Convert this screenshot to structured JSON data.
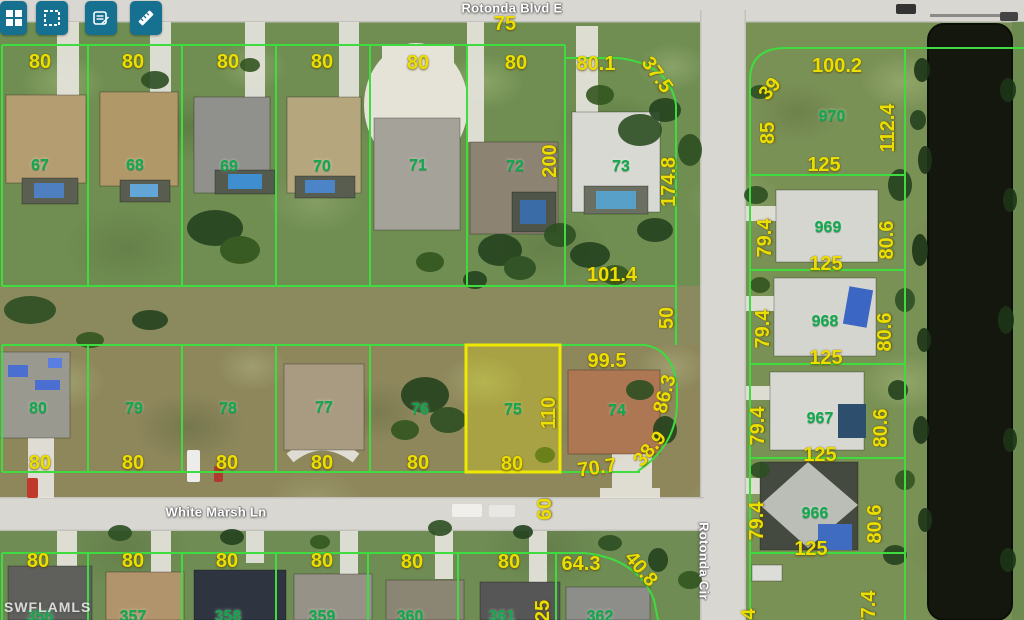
{
  "app": {
    "type": "parcel-map-viewer"
  },
  "colors": {
    "toolbar_teal": "#16708f",
    "parcel_line_green": "#3fdc3f",
    "highlight_yellow": "#efe800",
    "dimension_yellow": "#ecdf00",
    "parcel_number_green": "#14a84e",
    "water_dark": "#14170d",
    "road_gray": "#d8d7d2"
  },
  "toolbar": {
    "buttons": [
      {
        "icon": "layout-grid-icon"
      },
      {
        "icon": "select-area-icon"
      },
      {
        "icon": "notes-edit-icon"
      },
      {
        "icon": "measure-ruler-icon"
      }
    ]
  },
  "watermark": "SWFLAMLS",
  "highlight": {
    "parcel": "75"
  },
  "map_labels": {
    "streets": [
      {
        "t": "Rotonda Blvd E",
        "x": 512,
        "y": 8,
        "r": 0
      },
      {
        "t": "White Marsh Ln",
        "x": 216,
        "y": 512,
        "r": 0
      },
      {
        "t": "Rotonda Cir",
        "x": 704,
        "y": 561,
        "r": 90
      }
    ],
    "parcel_numbers": [
      {
        "t": "67",
        "x": 40,
        "y": 166
      },
      {
        "t": "68",
        "x": 135,
        "y": 166
      },
      {
        "t": "69",
        "x": 229,
        "y": 167
      },
      {
        "t": "70",
        "x": 322,
        "y": 167
      },
      {
        "t": "71",
        "x": 418,
        "y": 166
      },
      {
        "t": "72",
        "x": 515,
        "y": 167
      },
      {
        "t": "73",
        "x": 621,
        "y": 167
      },
      {
        "t": "970",
        "x": 832,
        "y": 117
      },
      {
        "t": "969",
        "x": 828,
        "y": 228
      },
      {
        "t": "968",
        "x": 825,
        "y": 322
      },
      {
        "t": "967",
        "x": 820,
        "y": 419
      },
      {
        "t": "966",
        "x": 815,
        "y": 514
      },
      {
        "t": "80",
        "x": 38,
        "y": 409
      },
      {
        "t": "79",
        "x": 134,
        "y": 409
      },
      {
        "t": "78",
        "x": 228,
        "y": 409
      },
      {
        "t": "77",
        "x": 324,
        "y": 408
      },
      {
        "t": "76",
        "x": 420,
        "y": 410
      },
      {
        "t": "75",
        "x": 513,
        "y": 410
      },
      {
        "t": "74",
        "x": 617,
        "y": 411
      },
      {
        "t": "356",
        "x": 40,
        "y": 617
      },
      {
        "t": "357",
        "x": 133,
        "y": 617
      },
      {
        "t": "358",
        "x": 228,
        "y": 617
      },
      {
        "t": "359",
        "x": 322,
        "y": 617
      },
      {
        "t": "360",
        "x": 410,
        "y": 617
      },
      {
        "t": "361",
        "x": 502,
        "y": 617
      },
      {
        "t": "362",
        "x": 600,
        "y": 617
      }
    ],
    "dimensions": [
      {
        "t": "80",
        "x": 40,
        "y": 62
      },
      {
        "t": "80",
        "x": 133,
        "y": 62
      },
      {
        "t": "80",
        "x": 228,
        "y": 62
      },
      {
        "t": "80",
        "x": 322,
        "y": 62
      },
      {
        "t": "80",
        "x": 418,
        "y": 63
      },
      {
        "t": "80",
        "x": 516,
        "y": 63
      },
      {
        "t": "80.1",
        "x": 596,
        "y": 64
      },
      {
        "t": "37.5",
        "x": 657,
        "y": 75,
        "r": 55
      },
      {
        "t": "200",
        "x": 550,
        "y": 161,
        "r": -90
      },
      {
        "t": "174.8",
        "x": 669,
        "y": 182,
        "r": -90
      },
      {
        "t": "75",
        "x": 505,
        "y": 24
      },
      {
        "t": "101.4",
        "x": 612,
        "y": 275
      },
      {
        "t": "50",
        "x": 667,
        "y": 318,
        "r": -90
      },
      {
        "t": "100.2",
        "x": 837,
        "y": 66
      },
      {
        "t": "39",
        "x": 770,
        "y": 89,
        "r": -50
      },
      {
        "t": "85",
        "x": 768,
        "y": 133,
        "r": -90
      },
      {
        "t": "112.4",
        "x": 888,
        "y": 128,
        "r": -90
      },
      {
        "t": "125",
        "x": 824,
        "y": 165
      },
      {
        "t": "79.4",
        "x": 765,
        "y": 238,
        "r": -90
      },
      {
        "t": "80.6",
        "x": 887,
        "y": 240,
        "r": -90
      },
      {
        "t": "125",
        "x": 826,
        "y": 264
      },
      {
        "t": "79.4",
        "x": 763,
        "y": 329,
        "r": -90
      },
      {
        "t": "80.6",
        "x": 885,
        "y": 332,
        "r": -90
      },
      {
        "t": "125",
        "x": 826,
        "y": 358
      },
      {
        "t": "79.4",
        "x": 758,
        "y": 426,
        "r": -90
      },
      {
        "t": "80.6",
        "x": 881,
        "y": 428,
        "r": -90
      },
      {
        "t": "125",
        "x": 820,
        "y": 455
      },
      {
        "t": "79.4",
        "x": 757,
        "y": 521,
        "r": -90
      },
      {
        "t": "80.6",
        "x": 875,
        "y": 524,
        "r": -90
      },
      {
        "t": "125",
        "x": 811,
        "y": 549
      },
      {
        "t": "77.4",
        "x": 869,
        "y": 610,
        "r": -90
      },
      {
        "t": "79.4",
        "x": 749,
        "y": 628,
        "r": -90
      },
      {
        "t": "99.5",
        "x": 607,
        "y": 361
      },
      {
        "t": "110",
        "x": 549,
        "y": 413,
        "r": -90
      },
      {
        "t": "86.3",
        "x": 665,
        "y": 394,
        "r": -75
      },
      {
        "t": "38.9",
        "x": 650,
        "y": 449,
        "r": -50
      },
      {
        "t": "70.7",
        "x": 597,
        "y": 468,
        "r": -8
      },
      {
        "t": "80",
        "x": 40,
        "y": 463
      },
      {
        "t": "80",
        "x": 133,
        "y": 463
      },
      {
        "t": "80",
        "x": 227,
        "y": 463
      },
      {
        "t": "80",
        "x": 322,
        "y": 463
      },
      {
        "t": "80",
        "x": 418,
        "y": 463
      },
      {
        "t": "80",
        "x": 512,
        "y": 464
      },
      {
        "t": "60",
        "x": 545,
        "y": 509,
        "r": -90
      },
      {
        "t": "80",
        "x": 38,
        "y": 561
      },
      {
        "t": "80",
        "x": 133,
        "y": 561
      },
      {
        "t": "80",
        "x": 227,
        "y": 561
      },
      {
        "t": "80",
        "x": 322,
        "y": 561
      },
      {
        "t": "80",
        "x": 412,
        "y": 562
      },
      {
        "t": "80",
        "x": 509,
        "y": 562
      },
      {
        "t": "64.3",
        "x": 581,
        "y": 564
      },
      {
        "t": "40.8",
        "x": 641,
        "y": 569,
        "r": 50
      },
      {
        "t": "25",
        "x": 543,
        "y": 611,
        "r": -90
      }
    ]
  }
}
